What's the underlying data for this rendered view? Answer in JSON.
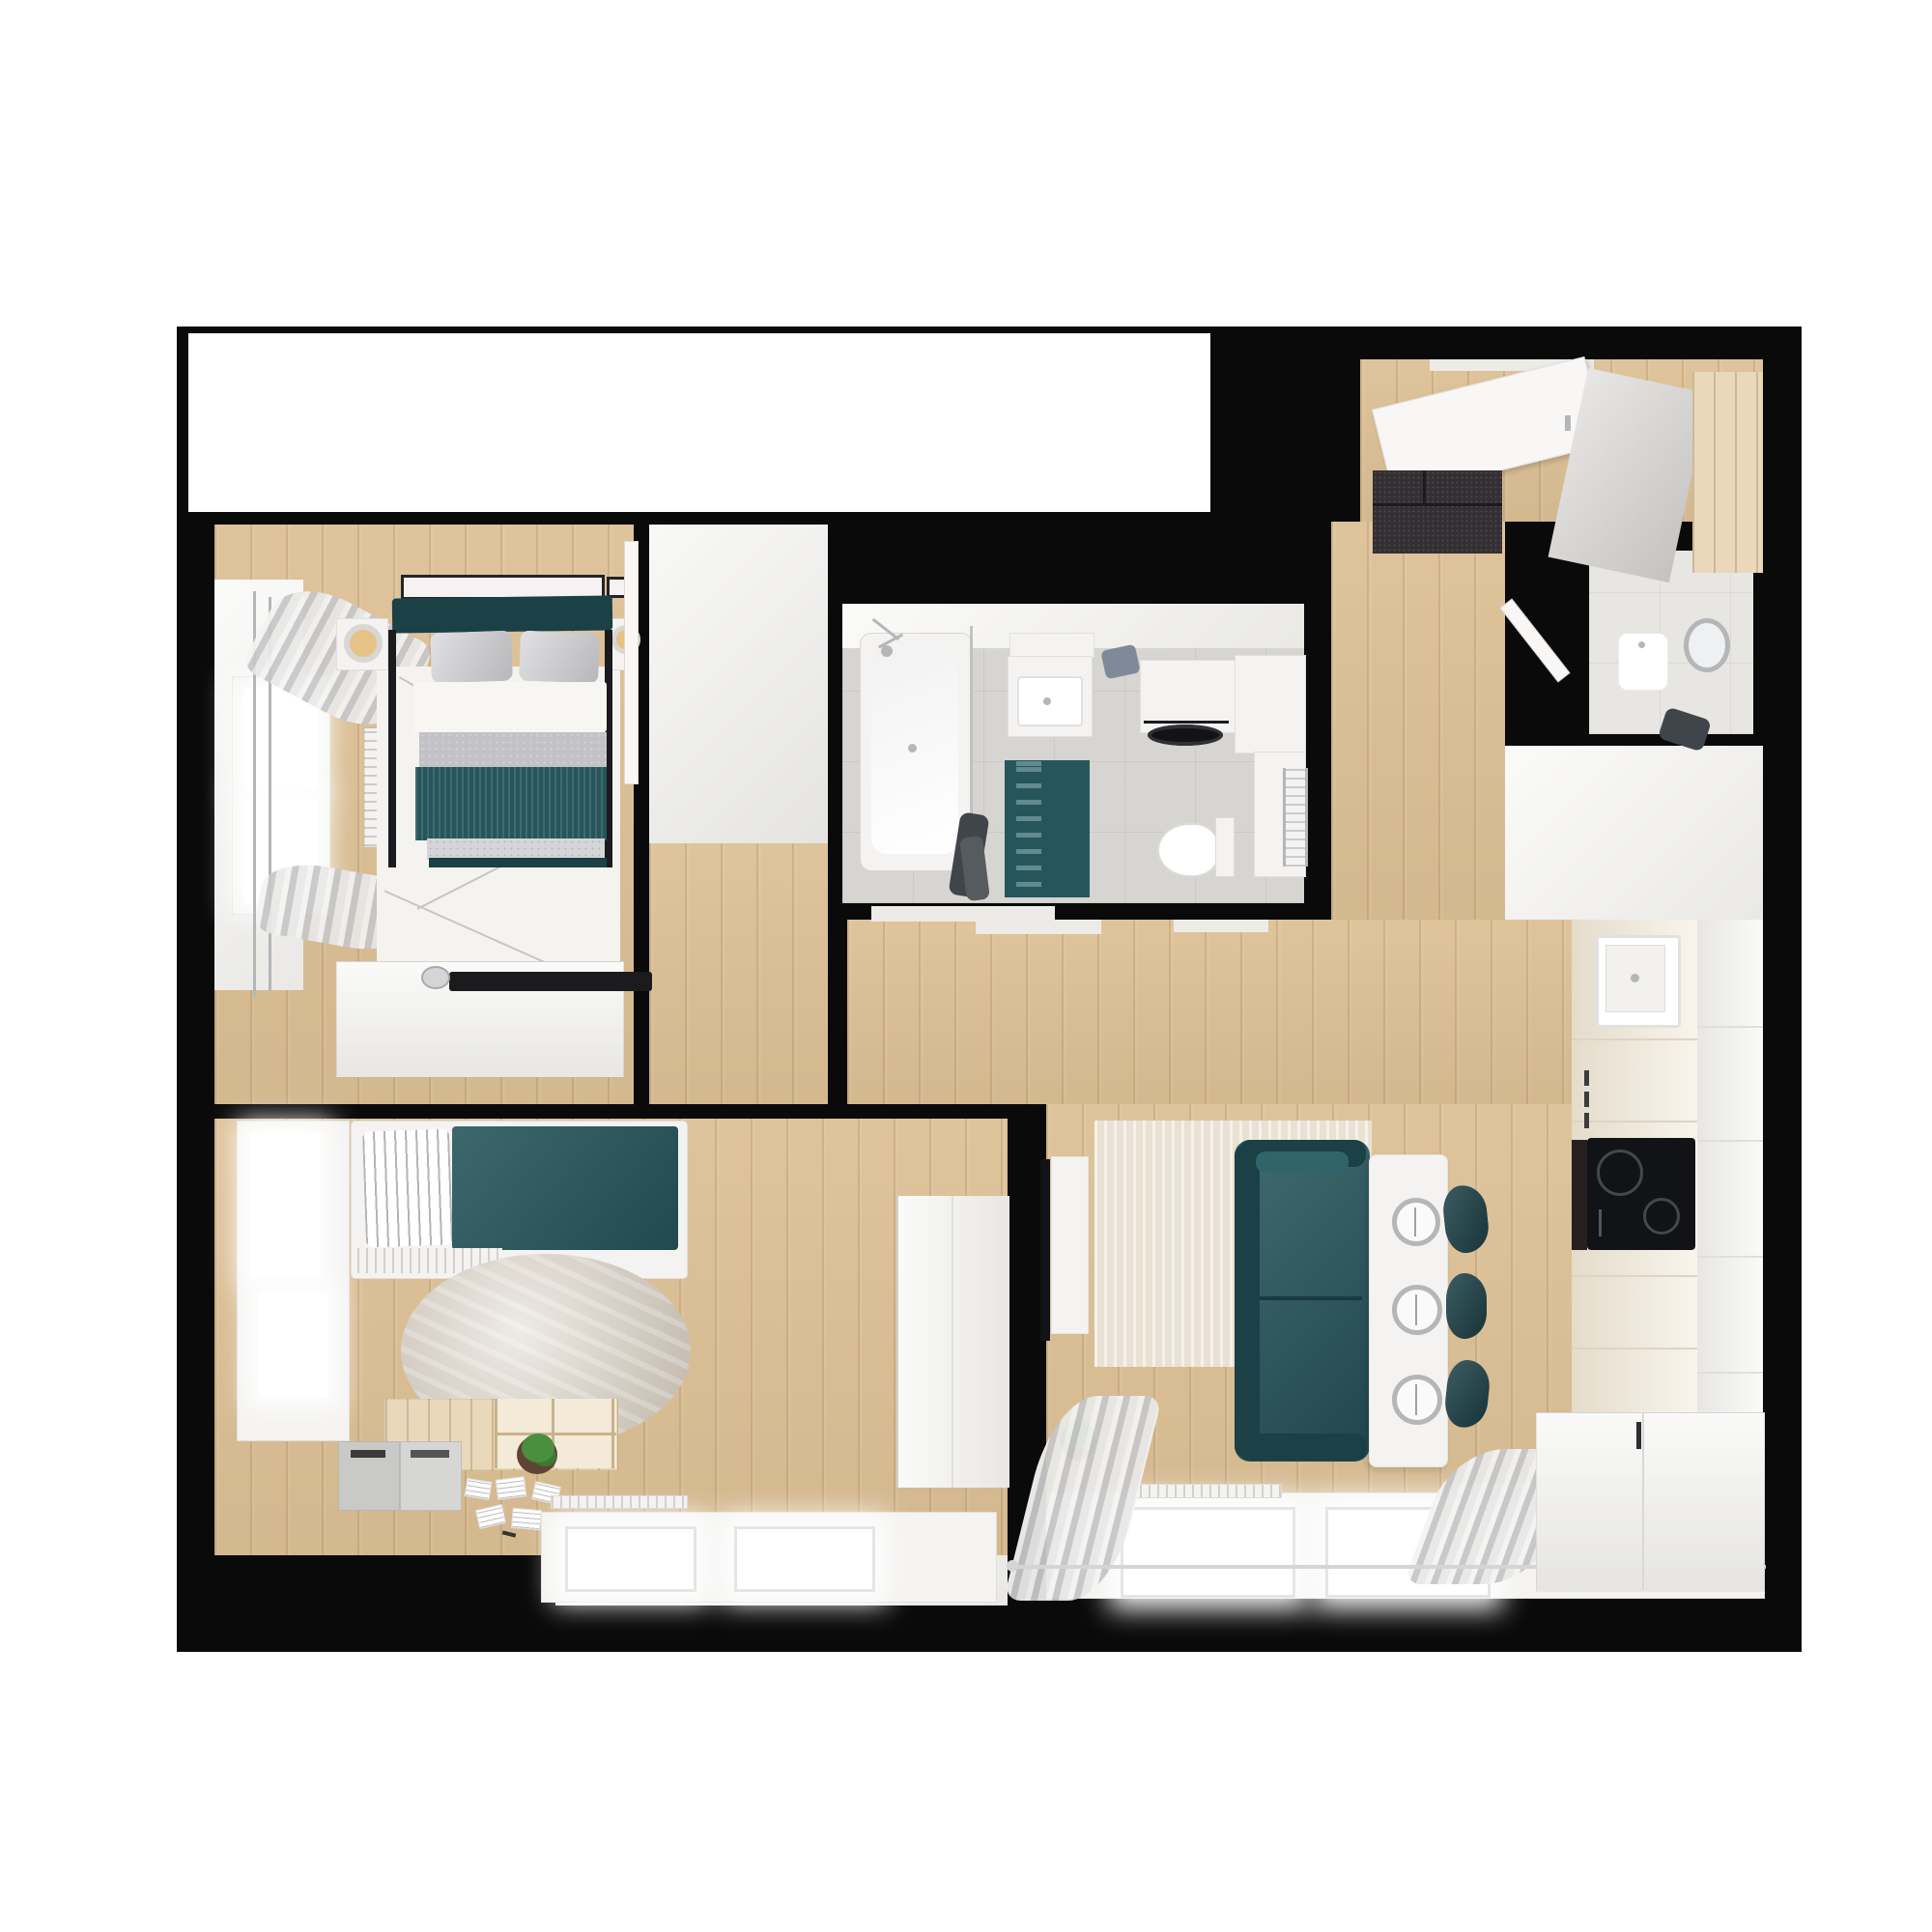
{
  "meta": {
    "image_kind": "top-down 3D rendered apartment floor plan",
    "background": "#ffffff",
    "no_visible_text": true
  },
  "palette": {
    "wall": "#0a0a0a",
    "floor_white": "#f6f5f2",
    "floor_wood": "#dcbf94",
    "floor_tile": "#d7d5d1",
    "wc_tile": "#e7e6e3",
    "vest_white": "#f1f0ed",
    "teal": "#26565c",
    "teal_dark": "#1b4046",
    "grey_blanket": "#c3c2c6",
    "grey_light": "#d5d4d7",
    "duvet": "#f7f6f3",
    "rug_master": "#f4f3f0",
    "rug_beige": "#e9e1d3",
    "rug_round": "#cfc5b6",
    "furn_white": "#f4f3f1",
    "furn_cream": "#f2ead8",
    "wood_light": "#e9d8ba",
    "grey_box": "#c9c9c7",
    "grey_door": "#d4d2d0",
    "doormat": "#342f33",
    "appliance": "#121316",
    "oven": "#262120",
    "chrome": "#b4b6b8",
    "lamp": "#e6c287",
    "towel_blue": "#7e8a9a",
    "towel_dark": "#40454b",
    "glow": "#ffffff",
    "pot": "#5f4334",
    "leaf": "#4a8f3d",
    "decor_black": "#1b1b1d",
    "threshold": "#edebe7",
    "door_white": "#f8f7f5"
  },
  "rooms": [
    {
      "name": "unfinished-room",
      "floor": "white",
      "contents": []
    },
    {
      "name": "master-bedroom",
      "floor": "wood",
      "contents": [
        "double-bed with teal headboard and teal runner",
        "two grey pillows",
        "two nightstands with lamps",
        "wall frames",
        "white patterned rug",
        "dresser with black tray",
        "window",
        "sheer curtains",
        "radiator",
        "open door"
      ]
    },
    {
      "name": "bathroom",
      "floor": "grey tile",
      "contents": [
        "bathtub with shower",
        "glass screen",
        "hanging towels",
        "vanity sink",
        "washing machine",
        "corner cabinets",
        "towel radiator",
        "toilet",
        "teal bath mat",
        "blue towel"
      ]
    },
    {
      "name": "wc",
      "floor": "light tile",
      "contents": [
        "small sink",
        "round mirror",
        "dark towel",
        "open door"
      ]
    },
    {
      "name": "entry-hall",
      "floor": "wood",
      "contents": [
        "dark doormat",
        "open front door",
        "sliding-door wardrobe"
      ]
    },
    {
      "name": "corridor",
      "floor": "wood",
      "contents": []
    },
    {
      "name": "living-kitchen",
      "floor": "wood",
      "contents": [
        "teal sofa",
        "beige rug",
        "white island table with three place settings",
        "three teal bar stools",
        "TV on wall",
        "TV cabinet",
        "potted plant",
        "kitchen counter with sink and induction hob",
        "tall white cabinets",
        "bottom cabinet run",
        "windows with sheer curtains",
        "radiators",
        "curtain rod"
      ]
    },
    {
      "name": "kids-room",
      "floor": "wood",
      "contents": [
        "single bed with teal blanket and striped pillow",
        "round beige rug",
        "low wood shelf with cubbies",
        "two grey storage bins",
        "potted plant",
        "desk area with papers",
        "tall white wardrobe",
        "side windows",
        "bottom window"
      ]
    }
  ]
}
